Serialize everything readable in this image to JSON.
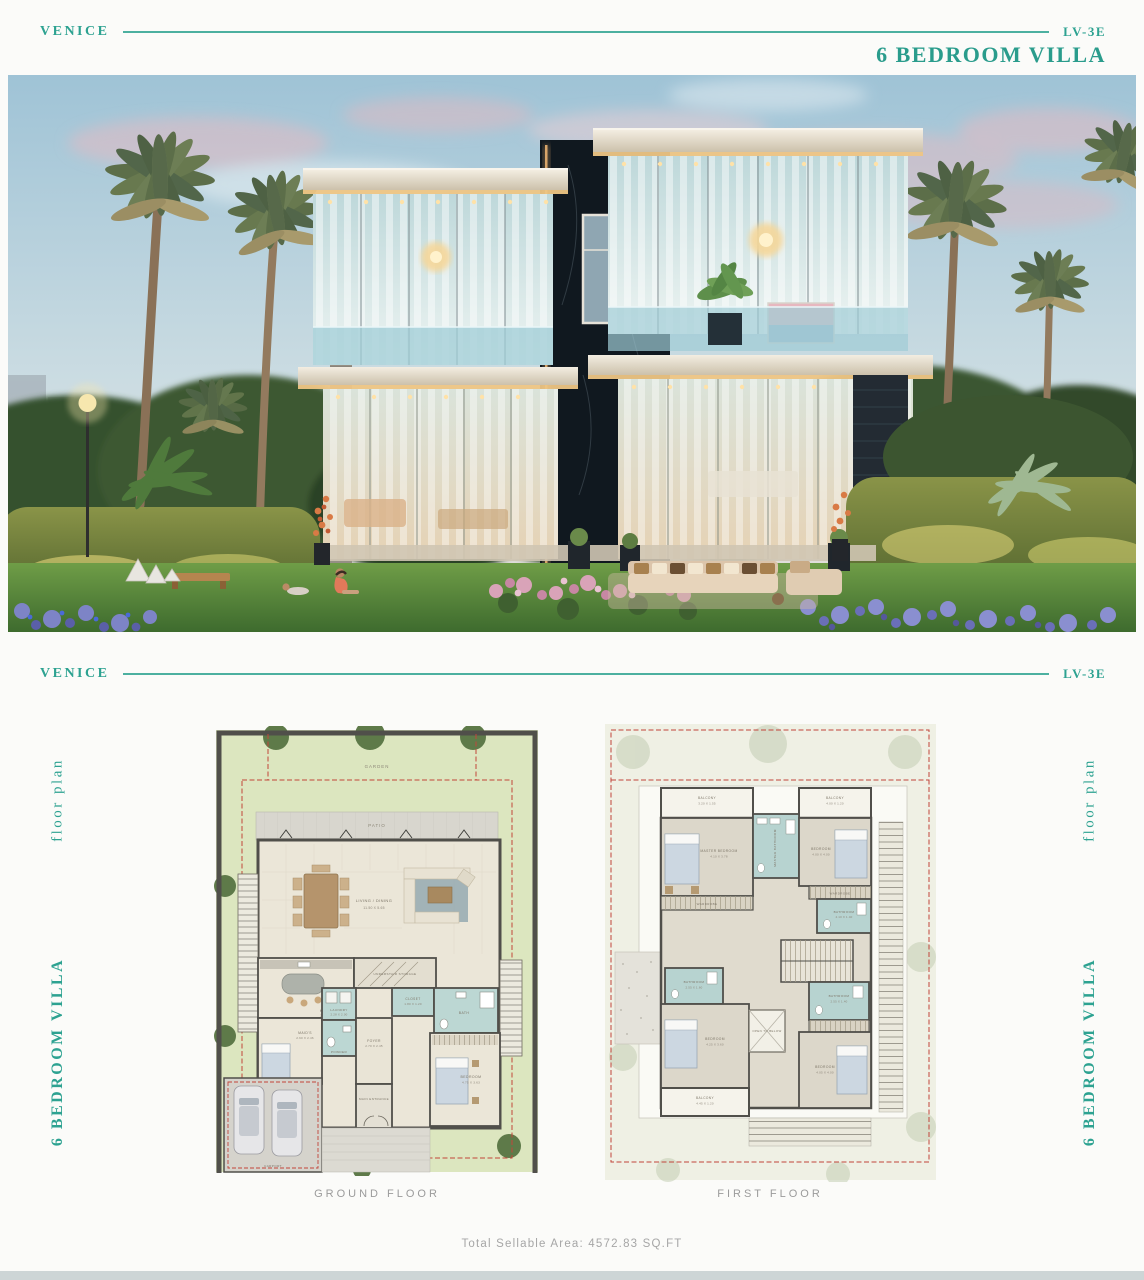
{
  "header_top": {
    "brand": "VENICE",
    "unit_code": "LV-3E",
    "title": "6 BEDROOM VILLA"
  },
  "header_plans": {
    "brand": "VENICE",
    "unit_code": "LV-3E"
  },
  "side_labels": {
    "floor_plan": "floor plan",
    "villa": "6 BEDROOM VILLA"
  },
  "colors": {
    "accent_teal": "#2da291",
    "caption_gray": "#9b9b9b",
    "plan_wall": "#504f4a",
    "plan_bath_blue": "#b7d3d0",
    "plan_lawn_green": "#dce6bf",
    "plot_line_red": "#c2453a"
  },
  "plans": {
    "ground": {
      "caption": "GROUND FLOOR",
      "garden": "GARDEN",
      "patio": "PATIO",
      "rooms": [
        {
          "name": "LIVING / DINING",
          "dims": "11.50 X 5.65"
        },
        {
          "name": "KITCHEN",
          "dims": "3.80 X 3.45"
        },
        {
          "name": "UNDERSTAIR STORAGE",
          "dims": ""
        },
        {
          "name": "CLOSET",
          "dims": "1.80 X 1.20"
        },
        {
          "name": "BATH",
          "dims": ""
        },
        {
          "name": "MAID'S",
          "dims": "2.60 X 2.46"
        },
        {
          "name": "LAUNDRY",
          "dims": "2.28 X 2.00"
        },
        {
          "name": "POWDER",
          "dims": ""
        },
        {
          "name": "FOYER",
          "dims": "2.70 X 2.45"
        },
        {
          "name": "BEDROOM",
          "dims": "4.75 X 3.63"
        },
        {
          "name": "MAIN ENTRANCE",
          "dims": ""
        },
        {
          "name": "CARPORT",
          "dims": ""
        }
      ]
    },
    "first": {
      "caption": "FIRST FLOOR",
      "rooms": [
        {
          "name": "BALCONY",
          "dims": "3.20 X 1.55"
        },
        {
          "name": "BALCONY",
          "dims": "4.00 X 1.20"
        },
        {
          "name": "MASTER BEDROOM",
          "dims": "4.10 X 3.78"
        },
        {
          "name": "MASTER BATHROOM",
          "dims": ""
        },
        {
          "name": "BEDROOM",
          "dims": "4.00 X 4.00"
        },
        {
          "name": "WARDROBE",
          "dims": ""
        },
        {
          "name": "BATHROOM",
          "dims": "4.10 X 1.40"
        },
        {
          "name": "BATHROOM",
          "dims": "2.55 X 1.60"
        },
        {
          "name": "BEDROOM",
          "dims": "4.25 X 3.60"
        },
        {
          "name": "OPEN TO BELOW",
          "dims": ""
        },
        {
          "name": "BATHROOM",
          "dims": "2.55 X 1.40"
        },
        {
          "name": "WARDROBE",
          "dims": ""
        },
        {
          "name": "BEDROOM",
          "dims": "4.05 X 4.00"
        },
        {
          "name": "BALCONY",
          "dims": "4.45 X 1.20"
        }
      ]
    }
  },
  "footer": {
    "total_area": "Total Sellable Area: 4572.83 SQ.FT"
  }
}
